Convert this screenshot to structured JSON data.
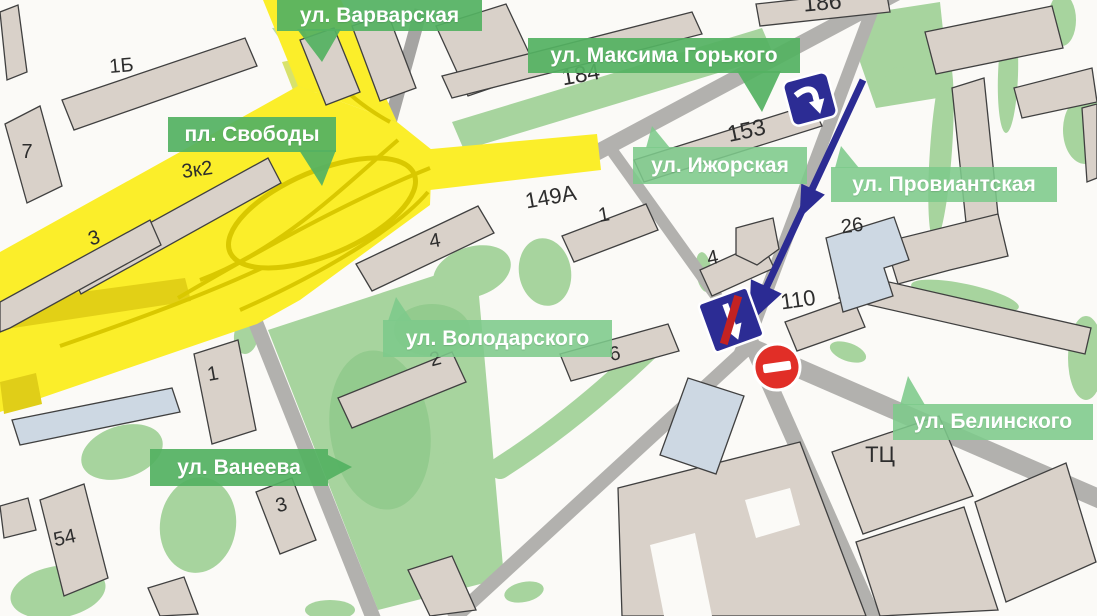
{
  "map_title": "Схема: пл. Свободы — ул. Провиантская (одностороннее движение)",
  "street_labels": [
    {
      "id": "varvarskaya",
      "text": "ул. Варварская",
      "style": "solid"
    },
    {
      "id": "svobody",
      "text": "пл. Свободы",
      "style": "solid"
    },
    {
      "id": "gorkogo",
      "text": "ул. Максима Горького",
      "style": "solid"
    },
    {
      "id": "izhorskaya",
      "text": "ул. Ижорская",
      "style": "light"
    },
    {
      "id": "proviantskaya",
      "text": "ул. Провиантская",
      "style": "light"
    },
    {
      "id": "volodarskogo",
      "text": "ул. Володарского",
      "style": "light"
    },
    {
      "id": "vaneeva",
      "text": "ул. Ванеева",
      "style": "solid"
    },
    {
      "id": "belinskogo",
      "text": "ул. Белинского",
      "style": "light"
    }
  ],
  "building_numbers": [
    "1Б",
    "7",
    "3к2",
    "3",
    "186",
    "184",
    "153",
    "149А",
    "1",
    "4",
    "4",
    "26",
    "110",
    "2",
    "6",
    "1",
    "3",
    "54",
    "ТЦ"
  ],
  "signs": [
    {
      "id": "one-way-start-sign",
      "meaning": "одностороннее движение"
    },
    {
      "id": "one-way-end-sign",
      "meaning": "конец одностороннего движения"
    },
    {
      "id": "no-entry-sign",
      "meaning": "въезд запрещён"
    }
  ],
  "route": {
    "description": "одностороннее движение по ул. Провиантская вниз к ул. Белинского"
  },
  "colors": {
    "label_green_solid": "#54b262",
    "label_green_light": "#7dc98b",
    "road_gray": "#b2b1ae",
    "building_beige": "#d9d1c9",
    "building_blue": "#cdd8e3",
    "park_green": "#a7d49e",
    "highlight_yellow": "#fbee2a",
    "highlight_yellow_dark": "#d9c800",
    "route_blue": "#2b2b93",
    "sign_blue": "#2c2c94",
    "no_entry_red": "#e12e27",
    "sign_red_stripe": "#c32222"
  }
}
